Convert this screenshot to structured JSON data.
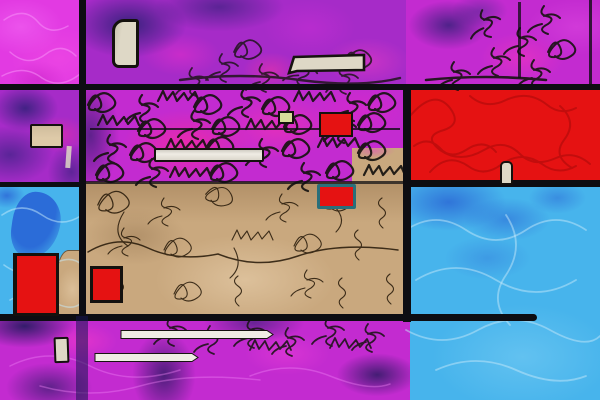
{
  "artwork": {
    "title": "Abstract color-block composition (Mondrian-style digital painting)",
    "description": "Grid of saturated color blocks separated by black lines, overlaid with dense black scribble textures, contour doodles and small outlined rectangles; no text content.",
    "palette": {
      "magenta_bright": "#e23ae2",
      "magenta_deep": "#c32bd0",
      "pink_hot": "#ff2f9f",
      "purple": "#a62bc8",
      "navy": "#23265e",
      "blue_light": "#47b4ec",
      "blue_royal": "#2b6cd8",
      "red": "#e51212",
      "red_dark": "#bd0d0d",
      "tan": "#c9a87e",
      "tan_light": "#decaa8",
      "cream": "#ded8c6",
      "white_bar": "#efece4",
      "yellow_pale": "#d7dc9a",
      "teal_border": "#2a6f7a",
      "ink": "#161310",
      "brown_ink": "#241707",
      "line_black": "#0d0d12"
    },
    "regions": [
      {
        "name": "top-left-magenta-block",
        "fill_key": "magenta_bright",
        "texture": "light pink swirls"
      },
      {
        "name": "left-purple-block",
        "fill_key": "purple",
        "texture": "navy blotches, pink spots"
      },
      {
        "name": "left-blue-block",
        "fill_key": "blue_light",
        "texture": "royal-blue blob, pale squiggles"
      },
      {
        "name": "center-top-purple-block",
        "fill_key": "purple",
        "texture": "navy patches, black doodles"
      },
      {
        "name": "center-scribble-band",
        "fill_key": "magenta_deep",
        "texture": "dense black scribbles over hot pink"
      },
      {
        "name": "center-tan-field",
        "fill_key": "tan",
        "texture": "brown contour doodles"
      },
      {
        "name": "right-top-magenta-block",
        "fill_key": "magenta_deep",
        "texture": "black branch scribbles, navy patch"
      },
      {
        "name": "right-red-block",
        "fill_key": "red",
        "texture": "dark red vein squiggles"
      },
      {
        "name": "right-blue-block",
        "fill_key": "blue_light",
        "texture": "royal-blue patches, pale squiggles"
      },
      {
        "name": "bottom-magenta-strip",
        "fill_key": "magenta_deep",
        "texture": "navy blotches, black scribbles"
      }
    ],
    "shapes": [
      {
        "name": "cream-tall-rect",
        "fill_key": "cream"
      },
      {
        "name": "left-cream-rect",
        "fill_key": "tan_light"
      },
      {
        "name": "cream-banner",
        "fill_key": "cream"
      },
      {
        "name": "mid-white-bar",
        "fill_key": "white_bar"
      },
      {
        "name": "yellow-rect",
        "fill_key": "yellow_pale"
      },
      {
        "name": "red-rect-top-center",
        "fill_key": "red"
      },
      {
        "name": "red-rect-teal-border",
        "fill_key": "red"
      },
      {
        "name": "left-red-rect",
        "fill_key": "red"
      },
      {
        "name": "center-red-square",
        "fill_key": "red"
      },
      {
        "name": "small-cream-rect",
        "fill_key": "cream"
      },
      {
        "name": "thin-white-bar-upper",
        "fill_key": "white_bar"
      },
      {
        "name": "thin-white-bar-lower",
        "fill_key": "white_bar"
      },
      {
        "name": "cream-pill-on-red",
        "fill_key": "cream"
      },
      {
        "name": "tan-patch-left-column",
        "fill_key": "tan"
      }
    ]
  }
}
